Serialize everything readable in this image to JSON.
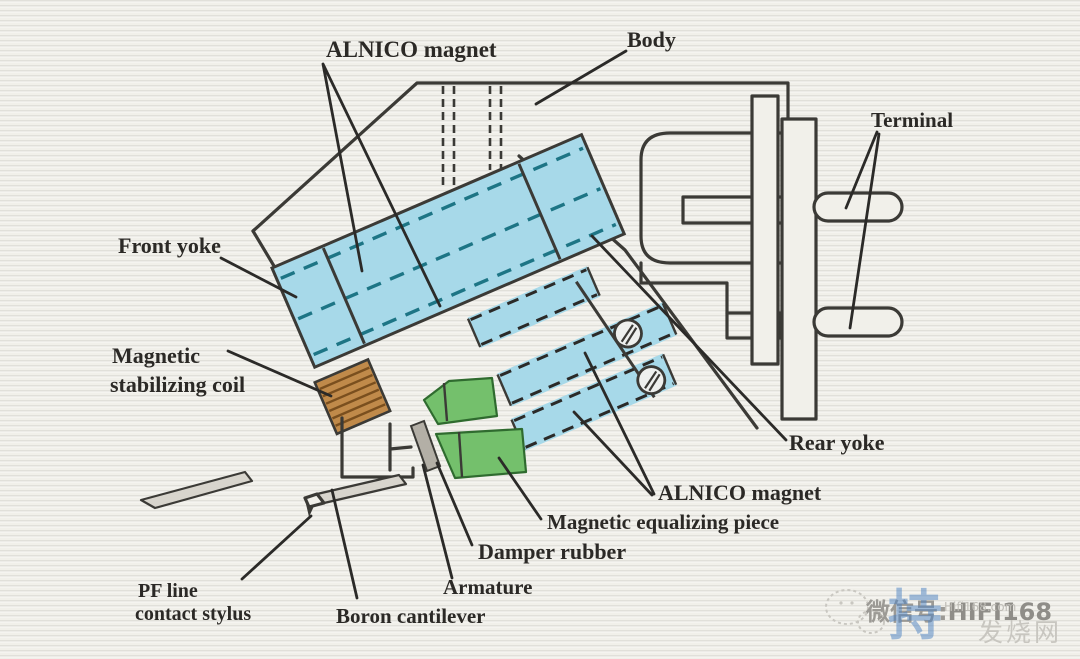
{
  "diagram": {
    "labels": {
      "alnico_top": "ALNICO magnet",
      "body": "Body",
      "terminal": "Terminal",
      "front_yoke": "Front yoke",
      "stabilizing_coil_line1": "Magnetic",
      "stabilizing_coil_line2": "stabilizing coil",
      "rear_yoke": "Rear yoke",
      "alnico_bottom": "ALNICO magnet",
      "equalizing_piece": "Magnetic equalizing piece",
      "damper_rubber": "Damper rubber",
      "armature": "Armature",
      "boron_cantilever": "Boron cantilever",
      "stylus_line1": "PF line",
      "stylus_line2": "contact stylus"
    }
  },
  "watermark": {
    "wechat_prefix": "微信号:",
    "wechat_id": "HIFI168",
    "site_url": "Hifi168.com",
    "site_name": "发烧网",
    "stamp_glyph": "持"
  },
  "colors": {
    "paper": "#f1f0ea",
    "outline": "#3b3a36",
    "leader_ink": "#2b2a28",
    "label_text": "#2b2926",
    "magnet_blue": "#a7d9e9",
    "dash_teal": "#1d7585",
    "coil_brown": "#c08a4a",
    "coil_stripe": "#7a4f1e",
    "rubber_green": "#74c06c",
    "green_edge": "#2f6b2f",
    "armature_gray": "#b3afa6",
    "watermark_gray": "#9c9a95",
    "watermark_light": "#c8c6c0",
    "stamp_blue": "#4a7fc1"
  }
}
